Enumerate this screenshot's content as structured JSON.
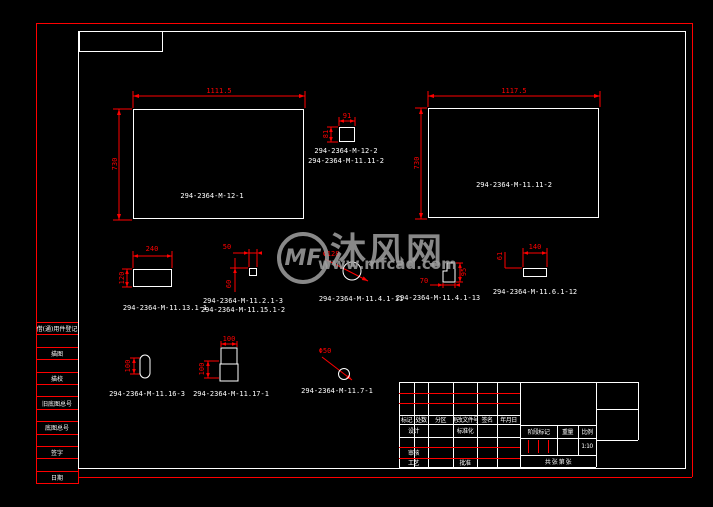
{
  "watermark": {
    "logo_text": "MF",
    "site_name": "沐风网",
    "site_url": "www.mfcad.com"
  },
  "colors": {
    "background": "#000000",
    "line_red": "#ff0000",
    "line_white": "#ffffff",
    "watermark_gray": "#a0a0a0"
  },
  "parts": {
    "panel_left": {
      "label": "294-2364-M-12-1",
      "width": "1111.5",
      "height": "730"
    },
    "panel_right": {
      "label": "294-2364-M-11.11-2",
      "width": "1117.5",
      "height": "730"
    },
    "square_top": {
      "labels": [
        "294-2364-M-12-2",
        "294-2364-M-11.11-2"
      ],
      "width": "91",
      "height": "81"
    },
    "block_a": {
      "label": "294-2364-M-11.13.1-1",
      "width": "240",
      "height": "120"
    },
    "block_b": {
      "labels": [
        "294-2364-M-11.2.1-3",
        "294-2364-M-11.15.1-2"
      ],
      "width": "50",
      "height": "60"
    },
    "disc": {
      "label": "294-2364-M-11.4.1-11",
      "diameter": "Φ128"
    },
    "step_block": {
      "label": "294-2364-M-11.4.1-13",
      "width": "70",
      "height": "95"
    },
    "bar": {
      "label": "294-2364-M-11.6.1-12",
      "width": "140",
      "height": "61"
    },
    "capsule": {
      "label": "294-2364-M-11.16-3",
      "height": "100"
    },
    "corner_block": {
      "label": "294-2364-M-11.17-1",
      "width": "100",
      "height": "100"
    },
    "pin": {
      "label": "294-2364-M-11.7-1",
      "diameter": "Φ50"
    }
  },
  "left_strip": {
    "rows": [
      "借(通)用件登记",
      "",
      "描图",
      "",
      "描校",
      "",
      "旧底图总号",
      "",
      "底图总号",
      "",
      "签字",
      "",
      "日期"
    ]
  },
  "title_block": {
    "change_header": [
      "标记",
      "处数",
      "分区",
      "更改文件号",
      "签名",
      "年月日"
    ],
    "design": "设计",
    "standardization": "标准化",
    "check": "审核",
    "process": "工艺",
    "approve": "批准",
    "stage_mark": "阶段标记",
    "weight": "重量",
    "scale": "比例",
    "scale_value": "1:10",
    "sheet_note": "共 张 第 张"
  }
}
